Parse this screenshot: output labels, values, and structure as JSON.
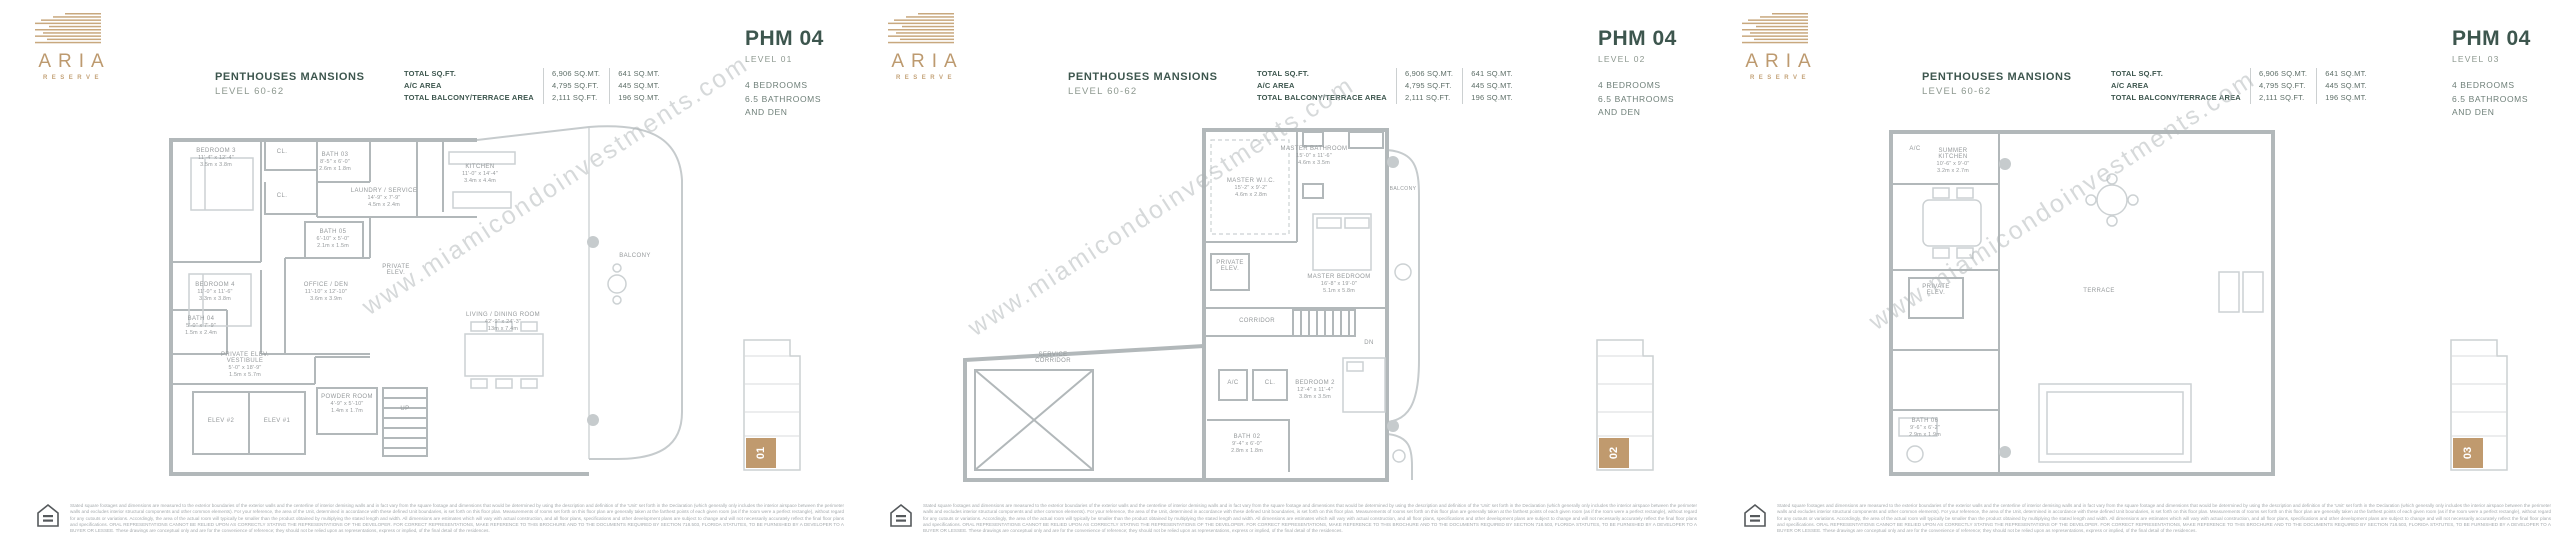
{
  "watermark": "www.miamicondoinvestments.com",
  "brand": {
    "name": "ARIA",
    "subname": "RESERVE"
  },
  "header": {
    "title": "PENTHOUSES MANSIONS",
    "level_range": "LEVEL 60-62",
    "stats": {
      "rows": [
        {
          "label": "TOTAL SQ.FT.",
          "imperial": "6,906 SQ.MT.",
          "metric": "641 SQ.MT."
        },
        {
          "label": "A/C AREA",
          "imperial": "4,795 SQ.FT.",
          "metric": "445 SQ.MT."
        },
        {
          "label": "TOTAL BALCONY/TERRACE AREA",
          "imperial": "2,111 SQ.FT.",
          "metric": "196 SQ.MT."
        }
      ]
    },
    "unit_name": "PHM 04",
    "features": [
      "4 BEDROOMS",
      "6.5 BATHROOMS",
      "AND DEN"
    ]
  },
  "panels": [
    {
      "level_label": "LEVEL 01",
      "key_number": "01",
      "rooms": {
        "bedroom3": {
          "name": "BEDROOM 3",
          "ft": "11'-4\" x 12'-4\"",
          "m": "3.5m x 3.8m"
        },
        "cl1": {
          "name": "CL."
        },
        "cl2": {
          "name": "CL."
        },
        "bath03": {
          "name": "BATH 03",
          "ft": "8'-5\" x 6'-0\"",
          "m": "2.6m x 1.8m"
        },
        "laundry": {
          "name": "LAUNDRY / SERVICE",
          "ft": "14'-9\" x 7'-9\"",
          "m": "4.5m x 2.4m"
        },
        "bath05": {
          "name": "BATH 05",
          "ft": "6'-10\" x 5'-0\"",
          "m": "2.1m x 1.5m"
        },
        "bedroom4": {
          "name": "BEDROOM 4",
          "ft": "11'-0\" x 11'-6\"",
          "m": "3.3m x 3.8m"
        },
        "office": {
          "name": "OFFICE / DEN",
          "ft": "11'-10\" x 12'-10\"",
          "m": "3.6m x 3.9m"
        },
        "bath04": {
          "name": "BATH 04",
          "ft": "5'-0\" x 7'-9\"",
          "m": "1.5m x 2.4m"
        },
        "kitchen": {
          "name": "KITCHEN",
          "ft": "11'-0\" x 14'-4\"",
          "m": "3.4m x 4.4m"
        },
        "living": {
          "name": "LIVING / DINING ROOM",
          "ft": "42'-9\" x 24'-3\"",
          "m": "13m x 7.4m"
        },
        "private_elev": {
          "name": "PRIVATE ELEV."
        },
        "vestibule": {
          "name": "PRIVATE ELEV. VESTIBULE",
          "ft": "5'-0\" x 18'-9\"",
          "m": "1.5m x 5.7m"
        },
        "elev2": {
          "name": "ELEV #2"
        },
        "elev1": {
          "name": "ELEV #1"
        },
        "powder": {
          "name": "POWDER ROOM",
          "ft": "4'-9\" x 5'-10\"",
          "m": "1.4m x 1.7m"
        },
        "up": {
          "name": "UP"
        },
        "balcony": {
          "name": "BALCONY"
        }
      }
    },
    {
      "level_label": "LEVEL 02",
      "key_number": "02",
      "rooms": {
        "master_bathroom": {
          "name": "MASTER BATHROOM",
          "ft": "15'-0\" x 11'-6\"",
          "m": "4.6m x 3.5m"
        },
        "master_wic": {
          "name": "MASTER W.I.C.",
          "ft": "15'-2\" x 9'-2\"",
          "m": "4.6m x 2.8m"
        },
        "master_bedroom": {
          "name": "MASTER BEDROOM",
          "ft": "16'-8\" x 19'-0\"",
          "m": "5.1m x 5.8m"
        },
        "balcony": {
          "name": "BALCONY"
        },
        "private_elev": {
          "name": "PRIVATE ELEV."
        },
        "corridor": {
          "name": "CORRIDOR"
        },
        "service_corridor": {
          "name": "SERVICE CORRIDOR"
        },
        "ac": {
          "name": "A/C"
        },
        "cl": {
          "name": "CL."
        },
        "bedroom2": {
          "name": "BEDROOM 2",
          "ft": "12'-4\" x 11'-4\"",
          "m": "3.8m x 3.5m"
        },
        "bath02": {
          "name": "BATH 02",
          "ft": "9'-4\" x 6'-0\"",
          "m": "2.8m x 1.8m"
        },
        "dn": {
          "name": "DN"
        }
      }
    },
    {
      "level_label": "LEVEL 03",
      "key_number": "03",
      "rooms": {
        "ac": {
          "name": "A/C"
        },
        "summer_kitchen": {
          "name": "SUMMER KITCHEN",
          "ft": "10'-6\" x 9'-0\"",
          "m": "3.2m x 2.7m"
        },
        "private_elev": {
          "name": "PRIVATE ELEV."
        },
        "terrace": {
          "name": "TERRACE"
        },
        "bath06": {
          "name": "BATH 06",
          "ft": "9'-6\" x 6'-2\"",
          "m": "2.9m x 1.9m"
        }
      }
    }
  ],
  "disclaimer": "Stated square footages and dimensions are measured to the exterior boundaries of the exterior walls and the centerline of interior demising walls and in fact vary from the square footage and dimensions that would be determined by using the description and definition of the 'Unit' set forth in the Declaration (which generally only includes the interior airspace between the perimeter walls and excludes interior structural components and other common elements). For your reference, the area of the Unit, determined in accordance with these defined Unit boundaries, is set forth on this floor plan. Measurements of rooms set forth on this floor plan are generally taken at the farthest points of each given room (as if the room were a perfect rectangle), without regard for any cutouts or variations. Accordingly, the area of the actual room will typically be smaller than the product obtained by multiplying the stated length and width. All dimensions are estimates which will vary with actual construction, and all floor plans, specifications and other development plans are subject to change and will not necessarily accurately reflect the final floor plans and specifications. ORAL REPRESENTATIONS CANNOT BE RELIED UPON AS CORRECTLY STATING THE REPRESENTATIONS OF THE DEVELOPER. FOR CORRECT REPRESENTATIONS, MAKE REFERENCE TO THIS BROCHURE AND TO THE DOCUMENTS REQUIRED BY SECTION 718.503, FLORIDA STATUTES, TO BE FURNISHED BY A DEVELOPER TO A BUYER OR LESSEE. These drawings are conceptual only and are for the convenience of reference; they should not be relied upon as representations, express or implied, of the final detail of the residences."
}
